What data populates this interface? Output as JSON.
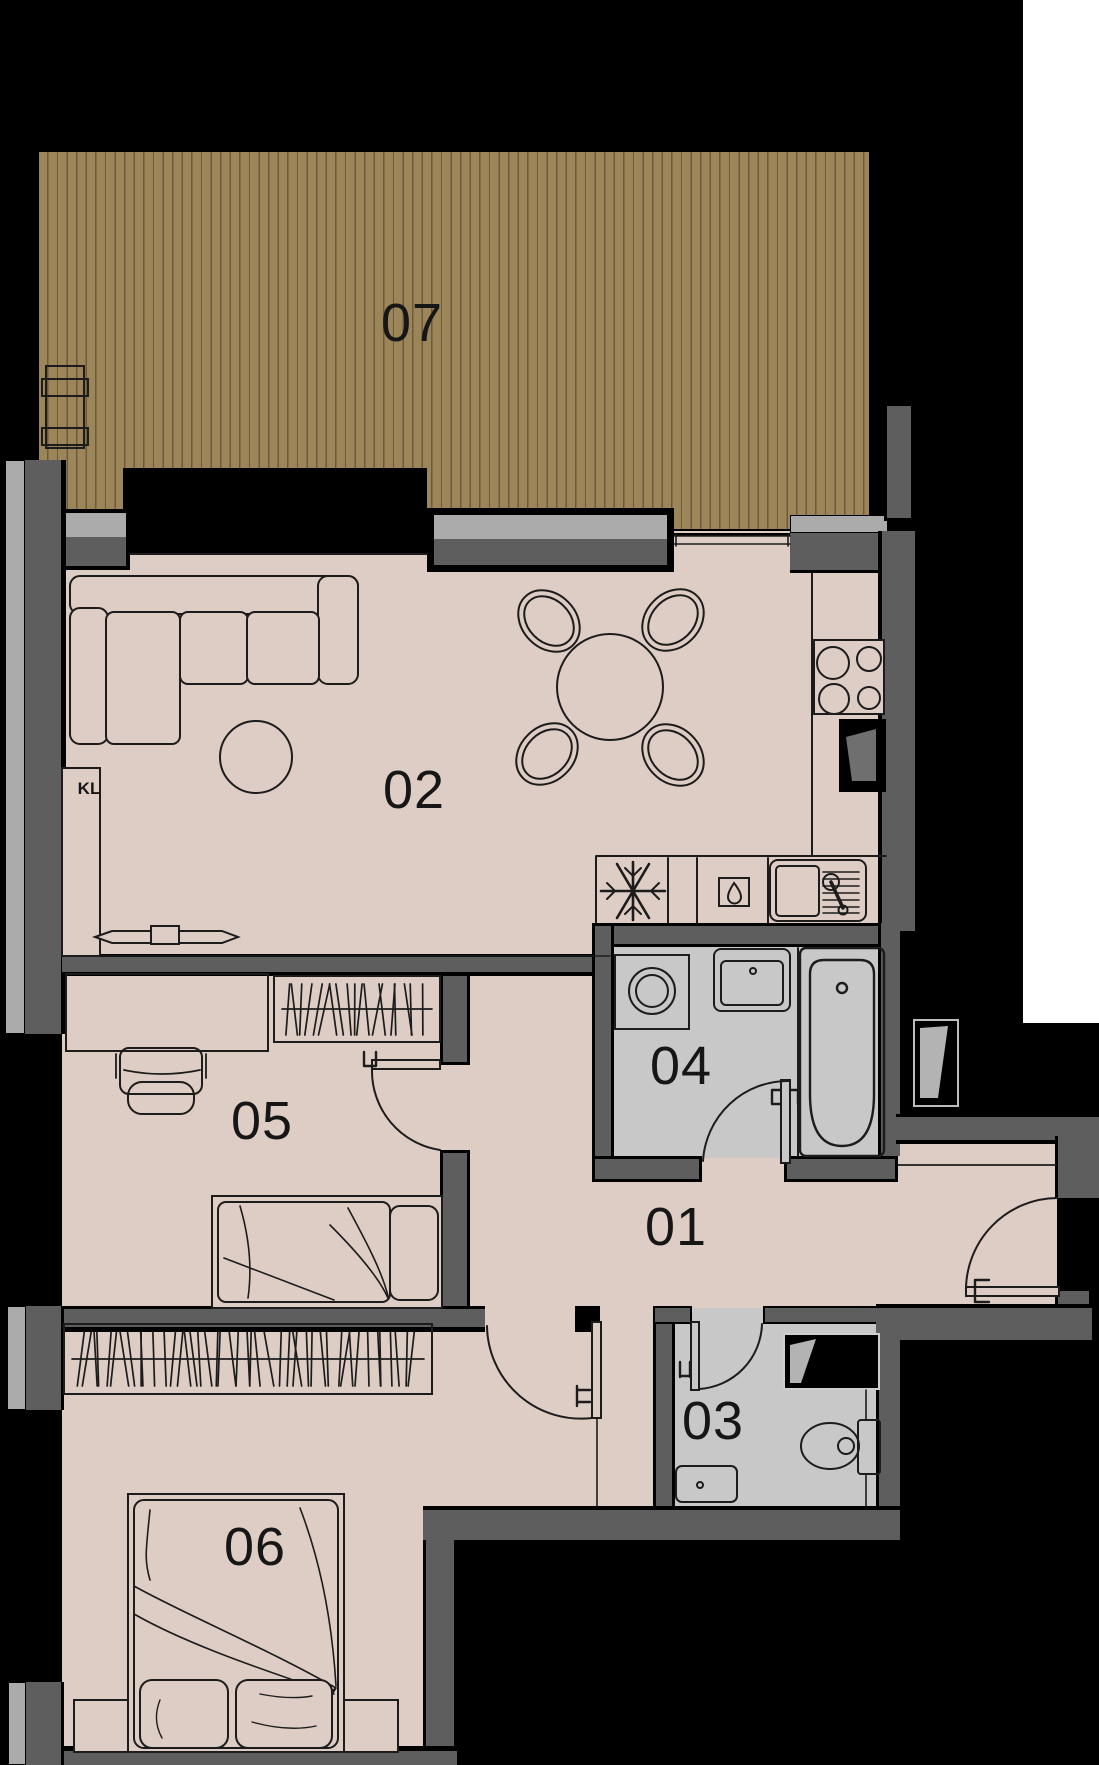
{
  "rooms": {
    "r01": {
      "label": "01"
    },
    "r02": {
      "label": "02"
    },
    "r03": {
      "label": "03"
    },
    "r04": {
      "label": "04"
    },
    "r05": {
      "label": "05"
    },
    "r06": {
      "label": "06"
    },
    "r07": {
      "label": "07"
    }
  },
  "annotations": {
    "closet": "KL"
  },
  "colors": {
    "background": "#000000",
    "page_margin": "#ffffff",
    "deck_wood": "#9c8659",
    "deck_stripe": "#6c5b3a",
    "floor": "#ddcdc5",
    "wet_room_floor": "#c8c8c8",
    "wall": "#5e5e5e",
    "window_sill": "#ababab",
    "outline": "#1c1c1c"
  },
  "icons": {
    "freezer": "snowflake-icon",
    "dishwasher": "water-drop-icon",
    "sink": "faucet-icon",
    "shafts": "installation-shaft"
  }
}
